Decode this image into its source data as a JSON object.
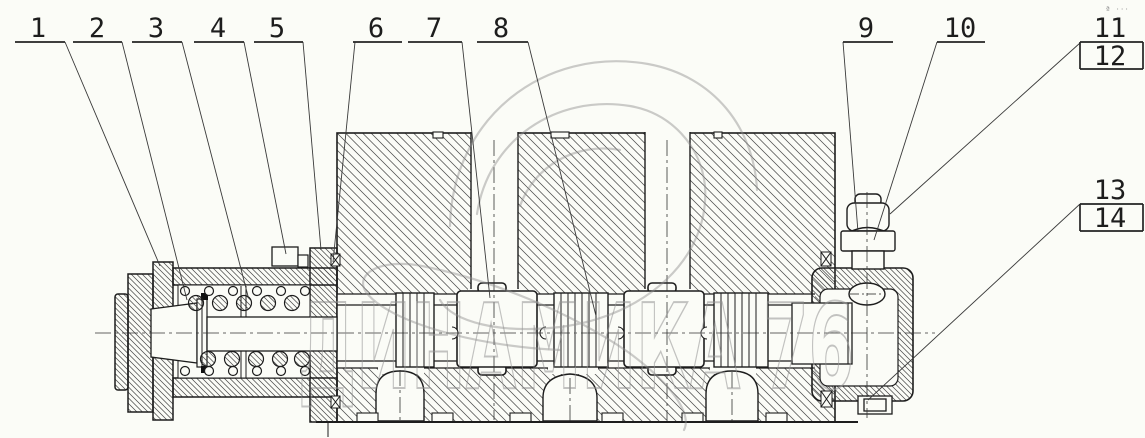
{
  "callouts": {
    "labels": [
      "1",
      "2",
      "3",
      "4",
      "5",
      "6",
      "7",
      "8",
      "9",
      "10",
      "11",
      "12",
      "13",
      "14"
    ]
  },
  "watermark": {
    "brand_text": "ДИНАМИКА 76",
    "corner_marks": "ª ···"
  },
  "colors": {
    "background": "#fbfcf7",
    "line": "#1d1d1d",
    "hatch": "#4a4a4a",
    "leader": "#3a3a3a",
    "watermark": "#949494"
  }
}
